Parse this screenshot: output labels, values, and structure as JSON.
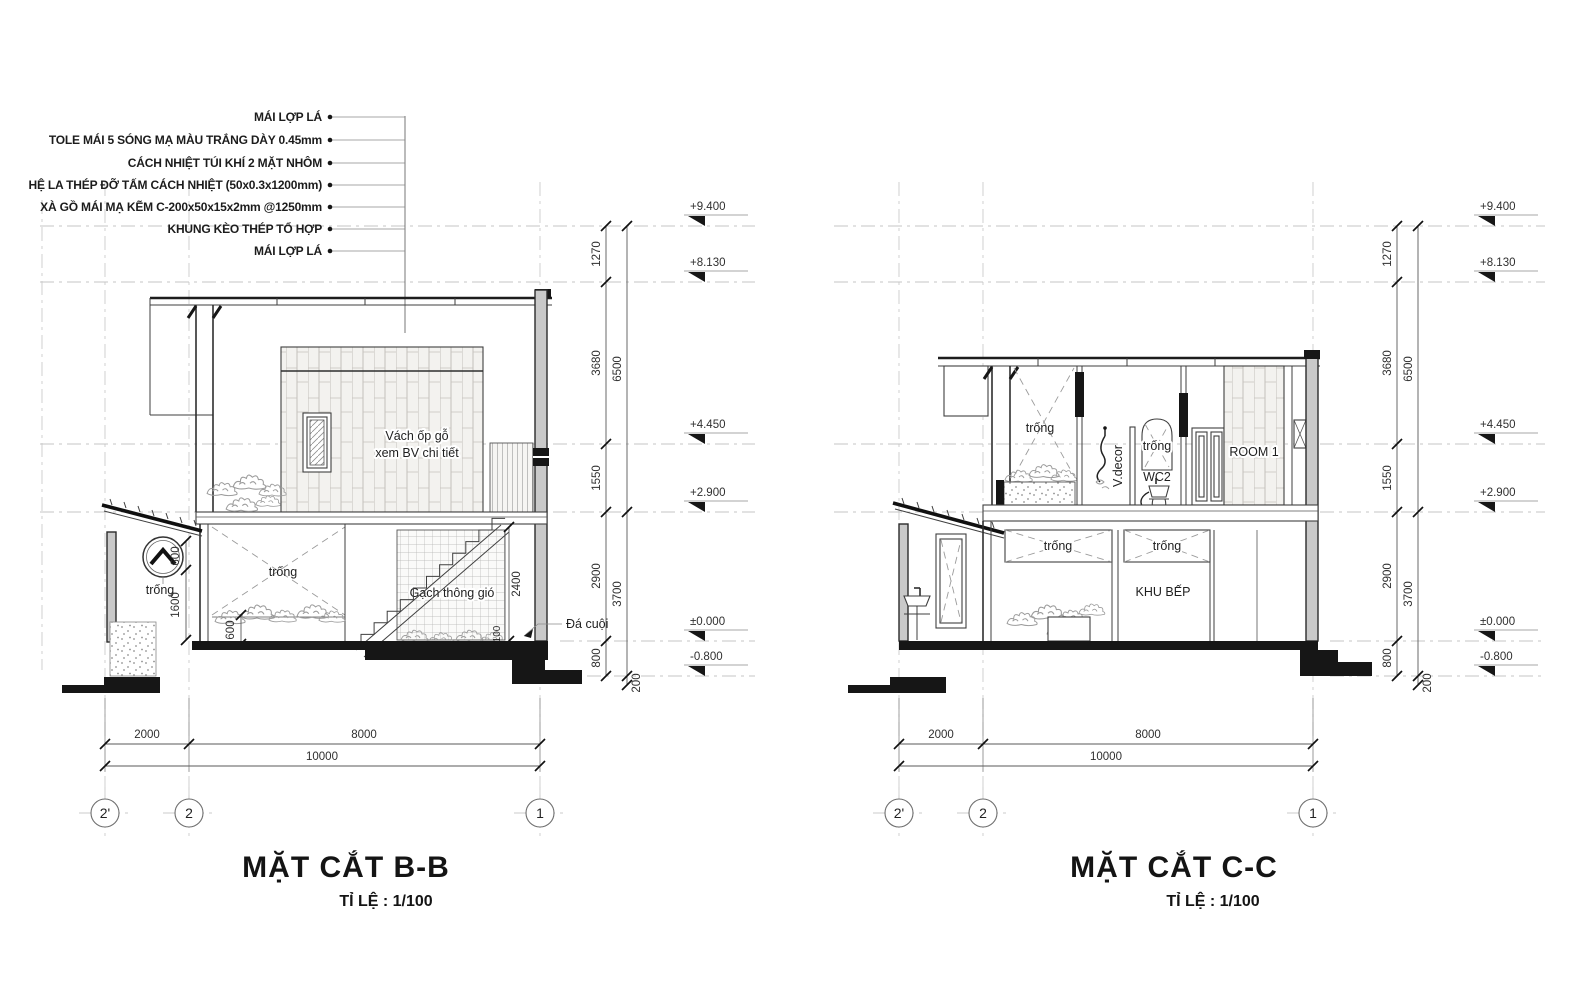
{
  "drawing": {
    "callouts": [
      "MÁI LỢP LÁ",
      "TOLE MÁI 5 SÓNG MẠ MÀU TRẮNG DÀY 0.45mm",
      "CÁCH NHIỆT TÚI KHÍ 2 MẶT NHÔM",
      "HỆ LA THÉP ĐỠ TẤM CÁCH NHIỆT (50x0.3x1200mm)",
      "XÀ GỒ MÁI MẠ KẼM C-200x50x15x2mm @1250mm",
      "KHUNG KÈO THÉP TỔ HỢP",
      "MÁI LỢP LÁ"
    ],
    "shared": {
      "levels": [
        "+9.400",
        "+8.130",
        "+4.450",
        "+2.900",
        "±0.000",
        "-0.800"
      ],
      "vdims_inner": [
        "1270",
        "3680",
        "1550",
        "2900",
        "800"
      ],
      "vdims_outer": [
        "6500",
        "3700",
        "200"
      ],
      "hdims": [
        "2000",
        "8000",
        "10000"
      ],
      "grid": [
        "2'",
        "2",
        "1"
      ]
    },
    "section_bb": {
      "title": "MẶT CẮT B-B",
      "scale_note": "TỈ LỆ : 1/100",
      "labels": {
        "wood_wall_line1": "Vách ốp gỗ",
        "wood_wall_line2": "xem BV chi tiết",
        "void_ground": "trống",
        "void_annex": "trống",
        "vent_brick": "Gạch thông gió",
        "pebble_note": "Đá cuội"
      },
      "local_dims": {
        "d600a": "600",
        "d1600": "1600",
        "d600b": "600",
        "d2400": "2400",
        "d100": "100"
      }
    },
    "section_cc": {
      "title": "MẶT CẮT C-C",
      "scale_note": "TỈ LỆ : 1/100",
      "labels": {
        "void_upper": "trống",
        "v_decor": "V.decor",
        "void_mirror": "trống",
        "wc2": "WC2",
        "room1": "ROOM 1",
        "void_low_left": "trống",
        "void_low_right": "trống",
        "kitchen": "KHU BẾP"
      }
    }
  }
}
